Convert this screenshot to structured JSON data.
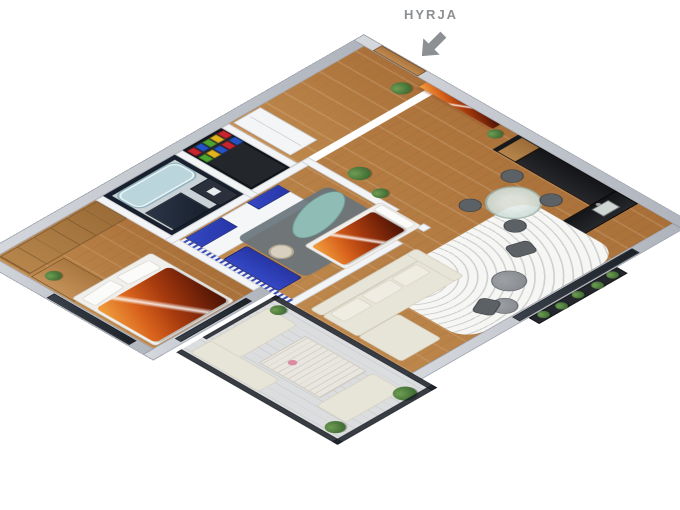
{
  "annotation": {
    "entrance_label": "HYRJA",
    "arrow_icon": "arrow-down-left-icon",
    "label_color": "#8d9093"
  },
  "scene": {
    "type": "isometric-3d-apartment-floor-plan-render",
    "rooms": [
      {
        "id": "master-bedroom",
        "features": [
          "wood-wardrobe",
          "desk",
          "desk-chair",
          "double-bed-canyon-print-duvet",
          "white-pillows",
          "west-windows"
        ]
      },
      {
        "id": "bathroom",
        "features": [
          "dark-tiled-walls",
          "bathtub",
          "shower",
          "vanity-sink"
        ]
      },
      {
        "id": "pantry",
        "features": [
          "colorful-storage-boxes"
        ]
      },
      {
        "id": "entry-hall",
        "features": [
          "entrance-door",
          "white-closet",
          "potted-plant"
        ]
      },
      {
        "id": "kids-room",
        "features": [
          "white-navy-wardrobe",
          "navy-bench",
          "striped-accent-wall",
          "slate-rug",
          "teal-lounger",
          "bed-canyon-print-duvet",
          "desk-chair"
        ]
      },
      {
        "id": "corridor",
        "features": [
          "canyon-wall-art",
          "potted-plants"
        ]
      },
      {
        "id": "kitchen",
        "features": [
          "tall-wood-cabinet",
          "black-countertop-east",
          "black-countertop-south",
          "sink",
          "faucet"
        ]
      },
      {
        "id": "living-dining",
        "features": [
          "cream-sectional-sofa",
          "patterned-white-rug",
          "round-coffee-tables",
          "glass-dining-table",
          "gray-dining-chairs",
          "gray-lounge-chairs",
          "south-windows",
          "planter-box"
        ]
      },
      {
        "id": "balcony",
        "features": [
          "glass-balustrade",
          "outdoor-corner-sofa",
          "slatted-table",
          "flowers",
          "bench",
          "potted-plants"
        ]
      }
    ]
  },
  "palette": {
    "wall_ext": "#aeb3bc",
    "wall_int": "#f3f4f6",
    "wood_light": "#c08a4e",
    "wood_dark": "#a86f38",
    "wardrobe_wood": "#9c6c38",
    "door_wood": "#a9743f",
    "navy": "#2735a6",
    "bath_dark": "#18202d",
    "bath_floor": "#c9d2d6",
    "tub": "#bad5dc",
    "canyon_hi": "#f2a341",
    "canyon_mid": "#a63a0e",
    "canyon_deep": "#471203",
    "cream": "#e7e4d8",
    "cream_deep": "#d5d1c2",
    "rug": "#f6f6f4",
    "slate": "#69747c",
    "teal": "#8fbcb4",
    "glass": "#1c2128",
    "glass_table": "#c4d6d0",
    "stone": "#dcdddf",
    "plant": "#3f6c33",
    "plant_light": "#6f9c53",
    "gray_table": "#83878b",
    "chair_gray": "#5c6166",
    "label": "#8d9093",
    "box_red": "#c8242f",
    "box_blue": "#2653c3",
    "box_green": "#4ea32f",
    "box_yellow": "#e0b31f"
  }
}
